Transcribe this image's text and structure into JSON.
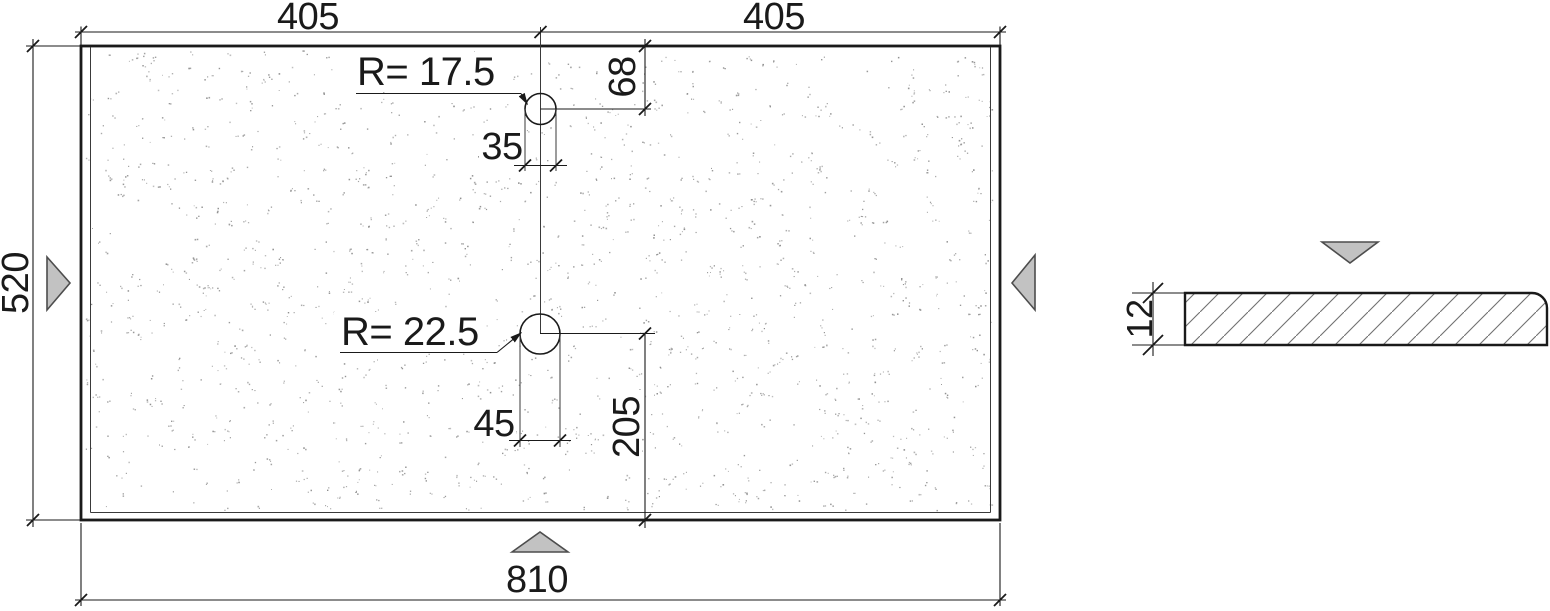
{
  "plan_view": {
    "dim_top_left": "405",
    "dim_top_right": "405",
    "dim_left_height": "520",
    "dim_bottom_width": "810",
    "hole_top": {
      "radius_label": "R= 17.5",
      "dim_offset_from_top": "68",
      "dim_width": "35"
    },
    "hole_bottom": {
      "radius_label": "R= 22.5",
      "dim_width": "45",
      "dim_offset_from_bottom": "205"
    }
  },
  "section_view": {
    "dim_thickness": "12"
  },
  "colors": {
    "line": "#1a1a1a",
    "thin_line": "#3a3a3a",
    "arrow_fill": "#c2c2c2",
    "arrow_stroke": "#4d4d4d",
    "stipple_dot": "#8f8f8f",
    "hatch_line": "#707070",
    "background": "#ffffff"
  },
  "texture": {
    "count": 1400,
    "pair_probability": 0.55,
    "seed": 7
  }
}
